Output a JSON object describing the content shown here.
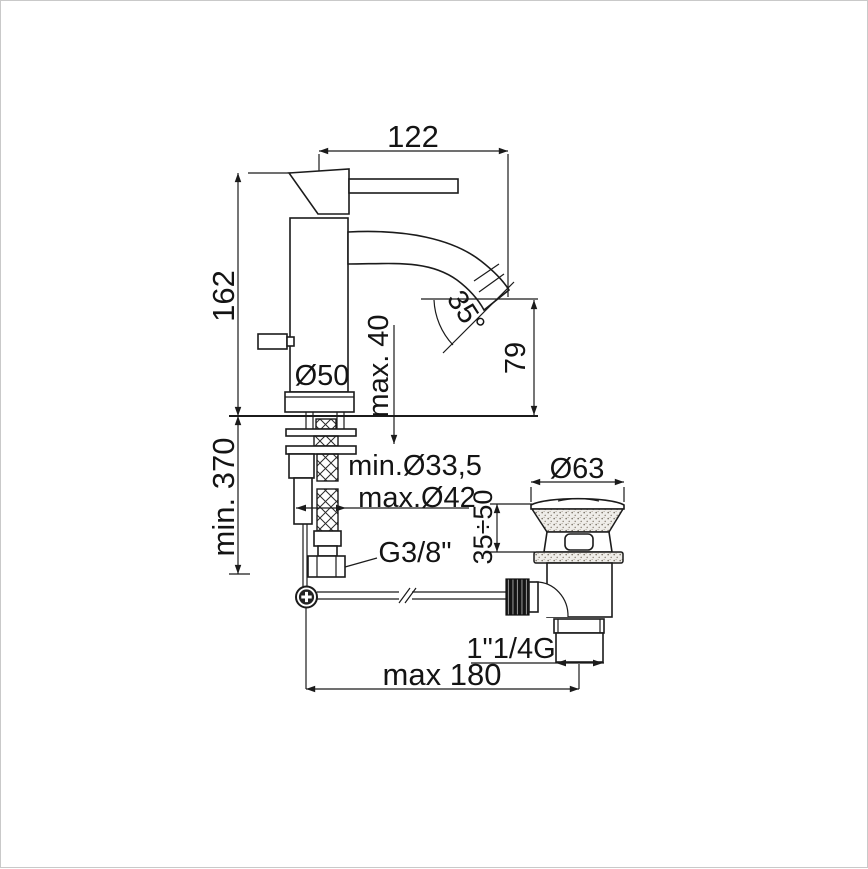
{
  "diagram": {
    "type": "technical-dimension-drawing",
    "subject": "single-lever basin mixer faucet with flexible supply hoses and pop-up waste drain",
    "background_color": "#ffffff",
    "line_color": "#1b1b1b",
    "border_color": "#c9c9c9"
  },
  "labels": {
    "spout_reach": "122",
    "body_height": "162",
    "deck_thickness": "max. 40",
    "base_diameter": "Ø50",
    "spout_angle": "35°",
    "spout_height": "79",
    "install_depth": "min. 370",
    "hole_min": "min.Ø33,5",
    "hole_max": "max.Ø42",
    "supply_thread": "G3/8\"",
    "waste_cap_diameter": "Ø63",
    "waste_deck_range": "35÷50",
    "waste_thread": "1\"1/4G",
    "rod_reach": "max 180"
  }
}
